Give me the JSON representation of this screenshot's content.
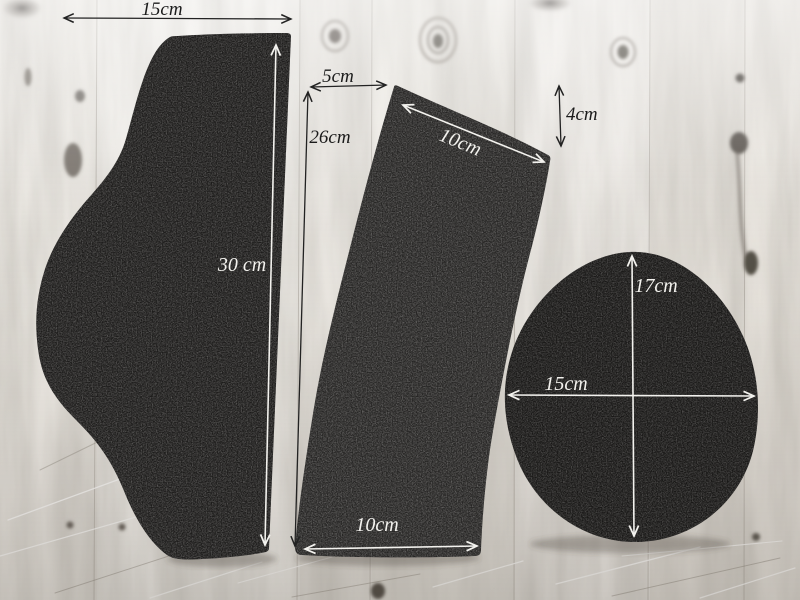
{
  "dimensions": {
    "left_piece_width": "15cm",
    "center_gap_top": "5cm",
    "center_gap_height": "26cm",
    "left_piece_height": "30 cm",
    "middle_piece_top_width": "10cm",
    "middle_piece_right_drop": "4cm",
    "round_piece_height": "17cm",
    "round_piece_width": "15cm",
    "middle_piece_bottom_width": "10cm"
  },
  "colors": {
    "wood_base": "#f0ede8",
    "wood_shadow": "#8a837b",
    "fabric_dark": "#1d1c1b",
    "fabric_mid": "#262524",
    "annotation_dark": "#1b1b1b",
    "annotation_light": "#f3f2ee"
  }
}
